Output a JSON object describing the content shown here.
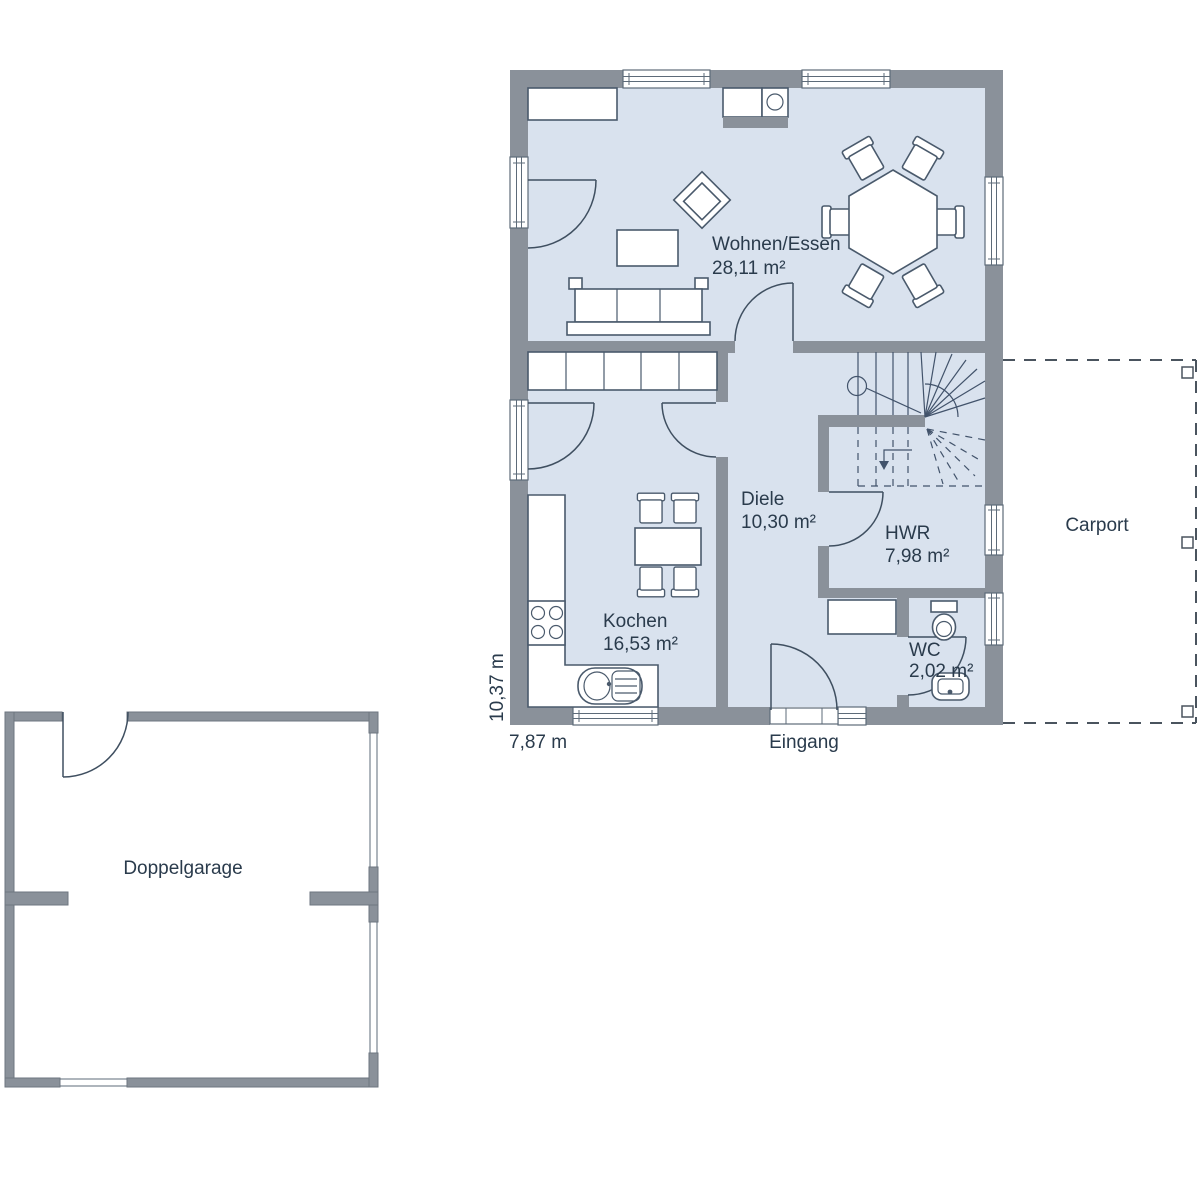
{
  "plan": {
    "rooms": [
      {
        "name": "Wohnen/Essen",
        "area": "28,11 m²"
      },
      {
        "name": "Kochen",
        "area": "16,53 m²"
      },
      {
        "name": "Diele",
        "area": "10,30 m²"
      },
      {
        "name": "HWR",
        "area": "7,98 m²"
      },
      {
        "name": "WC",
        "area": "2,02 m²"
      }
    ],
    "labels": {
      "carport": "Carport",
      "garage": "Doppelgarage",
      "entrance": "Eingang"
    },
    "dimensions": {
      "width": "7,87 m",
      "depth": "10,37 m"
    },
    "colors": {
      "wall": "#8a919a",
      "floor": "#d9e2ee",
      "outline": "#4a5a6c",
      "text": "#2a3b4c"
    }
  }
}
